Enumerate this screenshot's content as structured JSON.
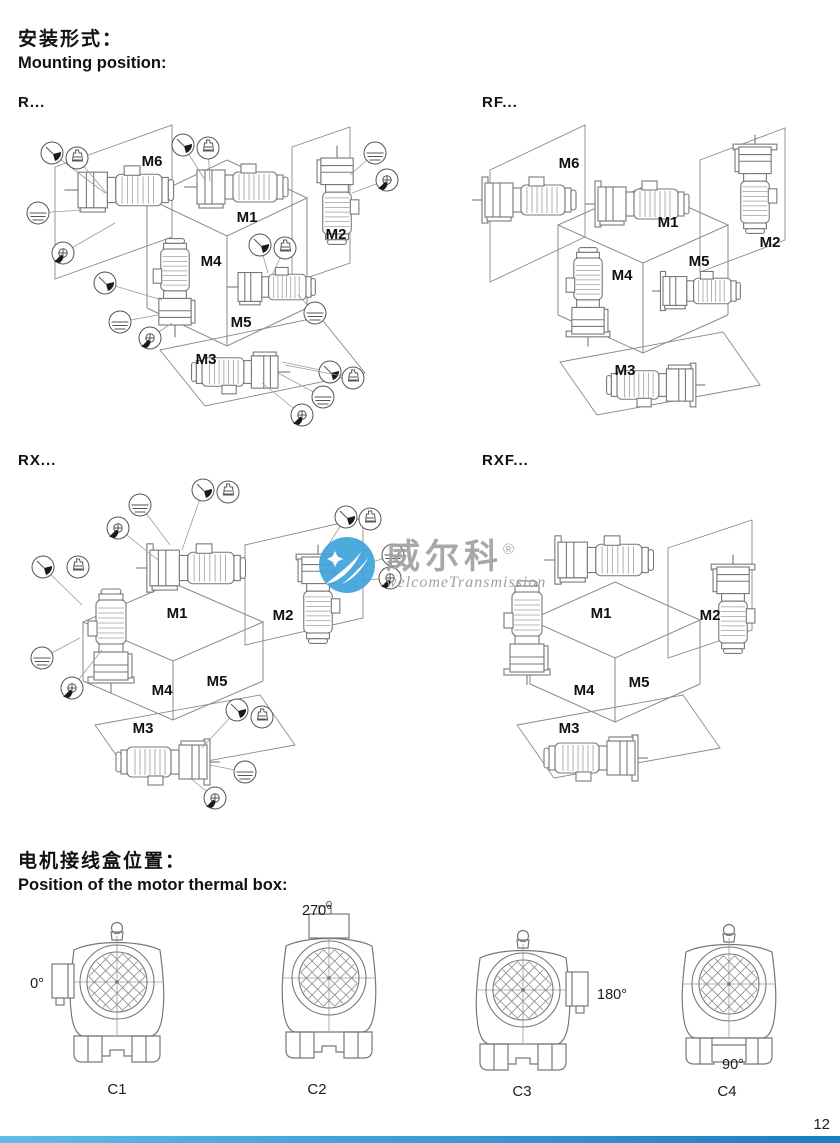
{
  "page": {
    "number": "12"
  },
  "mounting": {
    "heading_zh": "安装形式：",
    "heading_en": "Mounting position:",
    "diagrams": [
      {
        "id": "R",
        "series_label": "R...",
        "position_labels": [
          "M1",
          "M2",
          "M3",
          "M4",
          "M5",
          "M6"
        ],
        "symbols": [
          "vent-icon",
          "breather-icon",
          "oil-level-icon",
          "oil-drain-icon"
        ]
      },
      {
        "id": "RF",
        "series_label": "RF...",
        "position_labels": [
          "M1",
          "M2",
          "M3",
          "M4",
          "M5",
          "M6"
        ],
        "symbols": []
      },
      {
        "id": "RX",
        "series_label": "RX...",
        "position_labels": [
          "M1",
          "M2",
          "M3",
          "M4",
          "M5"
        ],
        "symbols": [
          "vent-icon",
          "breather-icon",
          "oil-level-icon",
          "oil-drain-icon"
        ]
      },
      {
        "id": "RXF",
        "series_label": "RXF...",
        "position_labels": [
          "M1",
          "M2",
          "M3",
          "M4",
          "M5"
        ],
        "symbols": []
      }
    ]
  },
  "thermal_box": {
    "heading_zh": "电机接线盒位置：",
    "heading_en": "Position of the motor thermal box:",
    "views": [
      {
        "label": "C1",
        "angle": "0°",
        "box_position": "left"
      },
      {
        "label": "C2",
        "angle": "270°",
        "box_position": "top"
      },
      {
        "label": "C3",
        "angle": "180°",
        "box_position": "right"
      },
      {
        "label": "C4",
        "angle": "90°",
        "box_position": "bottom"
      }
    ]
  },
  "watermark": {
    "brand_zh": "威尔科",
    "registered_mark": "®",
    "brand_en": "welcomeTransmission",
    "logo_color": "#41a3da"
  },
  "footer": {
    "accent_bar_color": "#2e93d5"
  }
}
